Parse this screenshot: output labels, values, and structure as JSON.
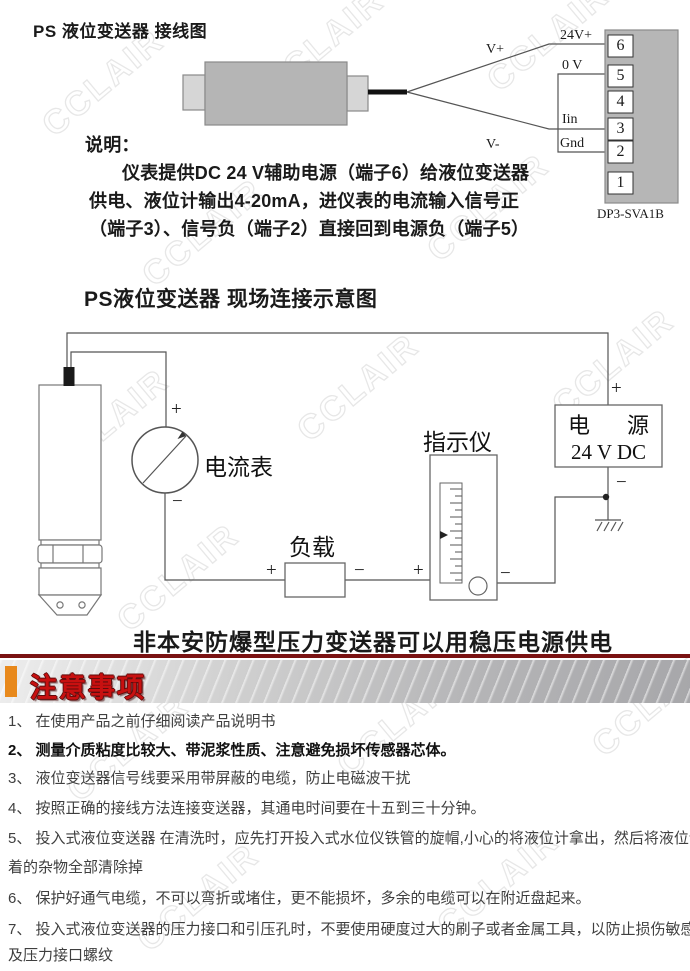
{
  "watermark": {
    "text": "CCLAIR"
  },
  "colors": {
    "notice_red": "#c81010",
    "accent_orange": "#e8891c",
    "maroon_line": "#7a1212",
    "diagram_gray": "#b5b5b5"
  },
  "wiring_diagram": {
    "title": "PS 液位变送器 接线图",
    "note_heading": "说明：",
    "note_lines": [
      "仪表提供DC 24 V辅助电源（端子6）给液位变送器",
      "供电、液位计输出4-20mA，进仪表的电流输入信号正",
      "（端子3）、信号负（端子2）直接回到电源负（端子5）"
    ],
    "labels": {
      "v_plus": "V+",
      "v_minus": "V-",
      "v24": "24V+",
      "zero_v": "0 V",
      "iin": "Iin",
      "gnd": "Gnd"
    },
    "terminals": [
      "6",
      "5",
      "4",
      "3",
      "2",
      "1"
    ],
    "module": "DP3-SVA1B"
  },
  "field_diagram": {
    "title": "PS液位变送器 现场连接示意图",
    "ammeter": "电流表",
    "load": "负载",
    "indicator": "指示仪",
    "power_name": [
      "电",
      "源"
    ],
    "power_rating": "24 V DC",
    "plus": "+",
    "minus": "−",
    "footer": "非本安防爆型压力变送器可以用稳压电源供电"
  },
  "notice": {
    "header": "注意事项",
    "lines": [
      {
        "text": "1、 在使用产品之前仔细阅读产品说明书",
        "bold": false
      },
      {
        "text": "2、 测量介质粘度比较大、带泥浆性质、注意避免损坏传感器芯体。",
        "bold": true
      },
      {
        "text": "3、 液位变送器信号线要采用带屏蔽的电缆，防止电磁波干扰",
        "bold": false
      },
      {
        "text": "4、 按照正确的接线方法连接变送器，其通电时间要在十五到三十分钟。",
        "bold": false
      },
      {
        "text": "5、 投入式液位变送器 在清洗时，应先打开投入式水位仪铁管的旋帽,小心的将液位计拿出，然后将液位计上附",
        "bold": false
      },
      {
        "text": "着的杂物全部清除掉",
        "bold": false
      },
      {
        "text": "6、 保护好通气电缆，不可以弯折或堵住，更不能损坏，多余的电缆可以在附近盘起来。",
        "bold": false
      },
      {
        "text": "7、 投入式液位变送器的压力接口和引压孔时，不要使用硬度过大的刷子或者金属工具，以防止损伤敏感芯子以",
        "bold": false
      },
      {
        "text": "及压力接口螺纹",
        "bold": false
      }
    ]
  }
}
